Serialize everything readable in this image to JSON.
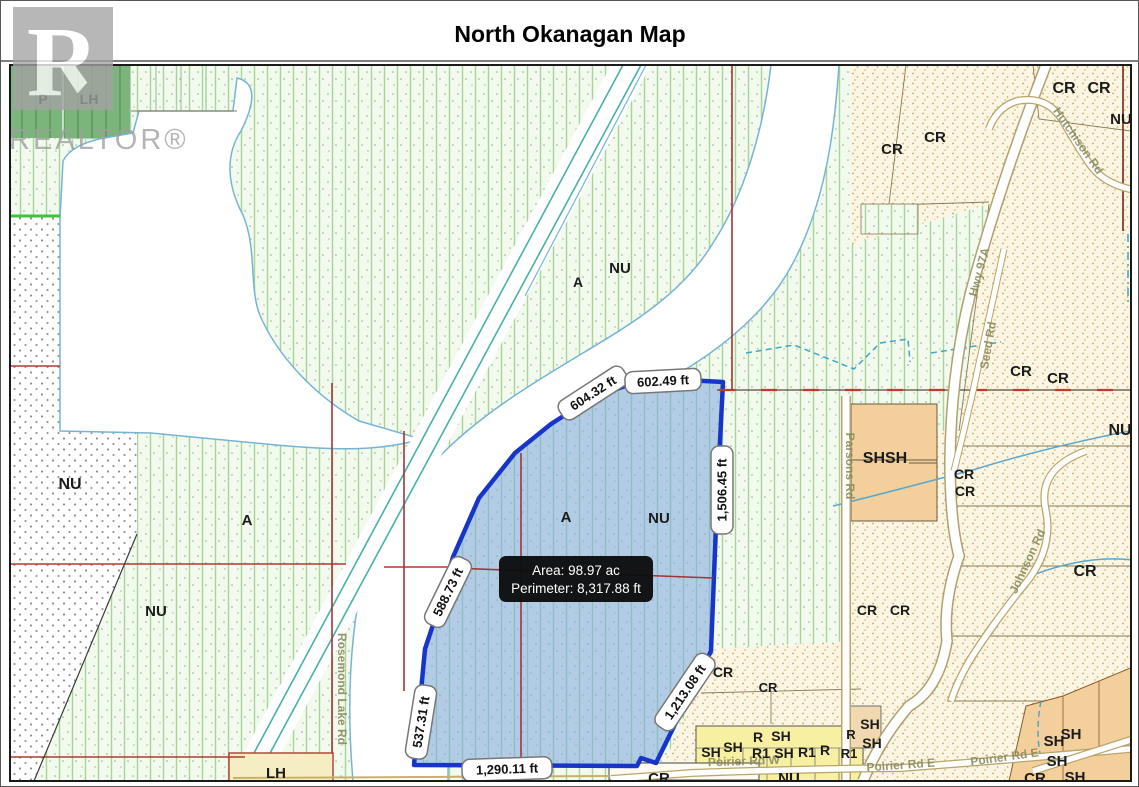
{
  "title": "North Okanagan Map",
  "watermark": {
    "logo_letter": "R",
    "text": "REALTOR®"
  },
  "parcel": {
    "tooltip": {
      "area": "Area: 98.97 ac",
      "perimeter": "Perimeter: 8,317.88 ft"
    },
    "measurements": [
      {
        "text": "604.32 ft"
      },
      {
        "text": "602.49 ft"
      },
      {
        "text": "1,506.45 ft"
      },
      {
        "text": "588.73 ft"
      },
      {
        "text": "537.31 ft"
      },
      {
        "text": "1,290.11 ft"
      },
      {
        "text": "1,213.08 ft"
      }
    ],
    "colors": {
      "fill": "#86aede",
      "border": "#1736c9",
      "tooltip_bg": "#0c0c0c"
    }
  },
  "zone_labels": [
    {
      "text": "P"
    },
    {
      "text": "LH"
    },
    {
      "text": "NU"
    },
    {
      "text": "A"
    },
    {
      "text": "NU"
    },
    {
      "text": "A"
    },
    {
      "text": "NU"
    },
    {
      "text": "A"
    },
    {
      "text": "NU"
    },
    {
      "text": "CR"
    },
    {
      "text": "CR"
    },
    {
      "text": "CR"
    },
    {
      "text": "CR"
    },
    {
      "text": "NU"
    },
    {
      "text": "CR"
    },
    {
      "text": "CR"
    },
    {
      "text": "SHSH"
    },
    {
      "text": "CR"
    },
    {
      "text": "CR"
    },
    {
      "text": "NU"
    },
    {
      "text": "CR"
    },
    {
      "text": "CR"
    },
    {
      "text": "CR"
    },
    {
      "text": "CR"
    },
    {
      "text": "CR"
    },
    {
      "text": "CR"
    },
    {
      "text": "NU"
    },
    {
      "text": "SH"
    },
    {
      "text": "SH"
    },
    {
      "text": "R"
    },
    {
      "text": "SH"
    },
    {
      "text": "R1"
    },
    {
      "text": "SH"
    },
    {
      "text": "R1"
    },
    {
      "text": "R"
    },
    {
      "text": "R1"
    },
    {
      "text": "R"
    },
    {
      "text": "SH"
    },
    {
      "text": "SH"
    },
    {
      "text": "SH"
    },
    {
      "text": "SH"
    },
    {
      "text": "SH"
    },
    {
      "text": "CR"
    },
    {
      "text": "SH"
    },
    {
      "text": "LH"
    }
  ],
  "road_labels": [
    {
      "text": "Hwy 97A"
    },
    {
      "text": "Seed Rd"
    },
    {
      "text": "Hutchison Rd"
    },
    {
      "text": "Parsons Rd"
    },
    {
      "text": "Johnson Rd"
    },
    {
      "text": "Rosemond Lake Rd"
    },
    {
      "text": "Poirier Rd W"
    },
    {
      "text": "Poirier Rd E"
    },
    {
      "text": "Poirier Rd E"
    }
  ]
}
